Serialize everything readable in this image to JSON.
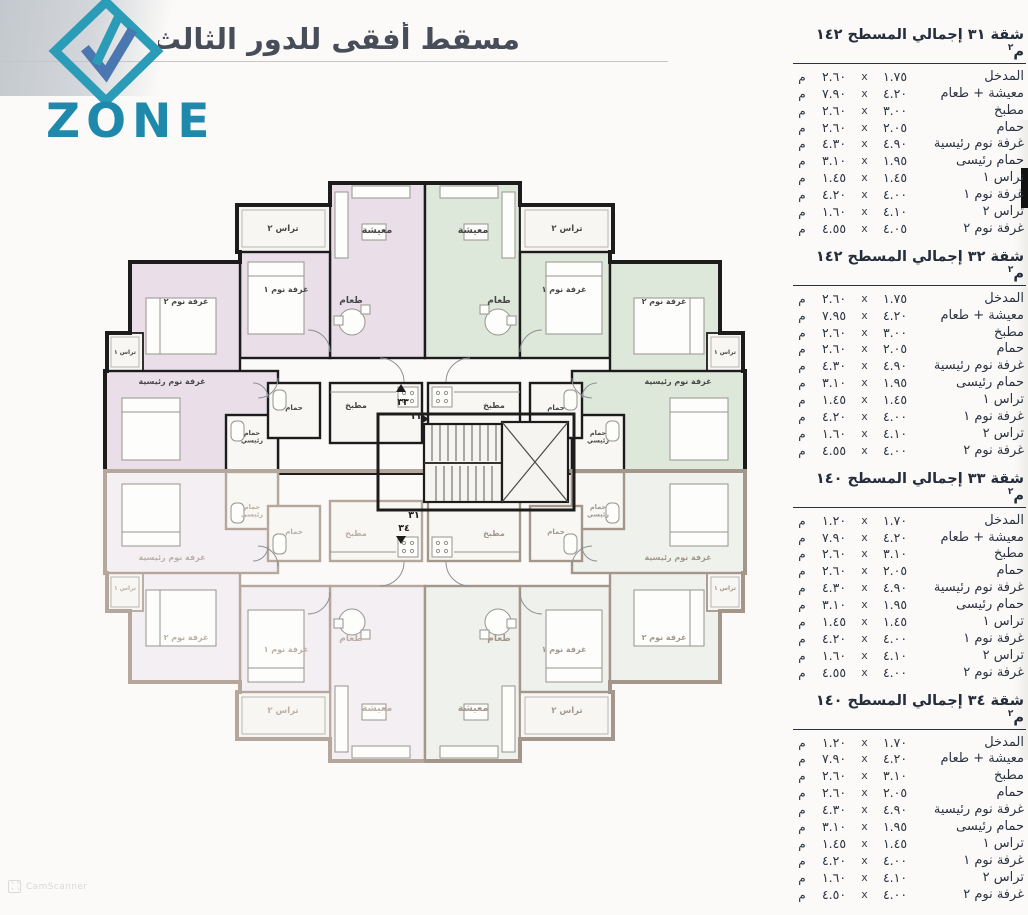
{
  "header": {
    "title": "مسقط أفقى للدور الثالث"
  },
  "logo": {
    "brand": "ZONE",
    "diamond_color": "#2a9cb7",
    "arrow_color": "#4a77b0",
    "text_color": "#1f89ac"
  },
  "tables": [
    {
      "title": "شقة ٣١ إجمالي المسطح ١٤٢ م",
      "title_sup": "٢",
      "rows": [
        {
          "label": "المدخل",
          "d1": "١.٧٥",
          "x": "x",
          "d2": "٢.٦٠",
          "unit": "م"
        },
        {
          "label": "معيشة + طعام",
          "d1": "٤.٢٠",
          "x": "x",
          "d2": "٧.٩٠",
          "unit": "م"
        },
        {
          "label": "مطبخ",
          "d1": "٣.٠٠",
          "x": "x",
          "d2": "٢.٦٠",
          "unit": "م"
        },
        {
          "label": "حمام",
          "d1": "٢.٠٥",
          "x": "x",
          "d2": "٢.٦٠",
          "unit": "م"
        },
        {
          "label": "غرفة نوم رئيسية",
          "d1": "٤.٩٠",
          "x": "x",
          "d2": "٤.٣٠",
          "unit": "م"
        },
        {
          "label": "حمام رئيسى",
          "d1": "١.٩٥",
          "x": "x",
          "d2": "٣.١٠",
          "unit": "م"
        },
        {
          "label": "تراس ١",
          "d1": "١.٤٥",
          "x": "x",
          "d2": "١.٤٥",
          "unit": "م"
        },
        {
          "label": "غرفة نوم ١",
          "d1": "٤.٠٠",
          "x": "x",
          "d2": "٤.٢٠",
          "unit": "م"
        },
        {
          "label": "تراس ٢",
          "d1": "٤.١٠",
          "x": "x",
          "d2": "١.٦٠",
          "unit": "م"
        },
        {
          "label": "غرفة نوم ٢",
          "d1": "٤.٠٥",
          "x": "x",
          "d2": "٤.٥٥",
          "unit": "م"
        }
      ]
    },
    {
      "title": "شقة ٣٢ إجمالي المسطح ١٤٢ م",
      "title_sup": "٢",
      "rows": [
        {
          "label": "المدخل",
          "d1": "١.٧٥",
          "x": "x",
          "d2": "٢.٦٠",
          "unit": "م"
        },
        {
          "label": "معيشة + طعام",
          "d1": "٤.٢٠",
          "x": "x",
          "d2": "٧.٩٥",
          "unit": "م"
        },
        {
          "label": "مطبخ",
          "d1": "٣.٠٠",
          "x": "x",
          "d2": "٢.٦٠",
          "unit": "م"
        },
        {
          "label": "حمام",
          "d1": "٢.٠٥",
          "x": "x",
          "d2": "٢.٦٠",
          "unit": "م"
        },
        {
          "label": "غرفة نوم رئيسية",
          "d1": "٤.٩٠",
          "x": "x",
          "d2": "٤.٣٠",
          "unit": "م"
        },
        {
          "label": "حمام رئيسى",
          "d1": "١.٩٥",
          "x": "x",
          "d2": "٣.١٠",
          "unit": "م"
        },
        {
          "label": "تراس ١",
          "d1": "١.٤٥",
          "x": "x",
          "d2": "١.٤٥",
          "unit": "م"
        },
        {
          "label": "غرفة نوم ١",
          "d1": "٤.٠٠",
          "x": "x",
          "d2": "٤.٢٠",
          "unit": "م"
        },
        {
          "label": "تراس ٢",
          "d1": "٤.١٠",
          "x": "x",
          "d2": "١.٦٠",
          "unit": "م"
        },
        {
          "label": "غرفة نوم ٢",
          "d1": "٤.٠٠",
          "x": "x",
          "d2": "٤.٥٥",
          "unit": "م"
        }
      ]
    },
    {
      "title": "شقة ٣٣ إجمالي المسطح ١٤٠ م",
      "title_sup": "٢",
      "rows": [
        {
          "label": "المدخل",
          "d1": "١.٧٠",
          "x": "x",
          "d2": "١.٢٠",
          "unit": "م"
        },
        {
          "label": "معيشة + طعام",
          "d1": "٤.٢٠",
          "x": "x",
          "d2": "٧.٩٠",
          "unit": "م"
        },
        {
          "label": "مطبخ",
          "d1": "٣.١٠",
          "x": "x",
          "d2": "٢.٦٠",
          "unit": "م"
        },
        {
          "label": "حمام",
          "d1": "٢.٠٥",
          "x": "x",
          "d2": "٢.٦٠",
          "unit": "م"
        },
        {
          "label": "غرفة نوم رئيسية",
          "d1": "٤.٩٠",
          "x": "x",
          "d2": "٤.٣٠",
          "unit": "م"
        },
        {
          "label": "حمام رئيسى",
          "d1": "١.٩٥",
          "x": "x",
          "d2": "٣.١٠",
          "unit": "م"
        },
        {
          "label": "تراس ١",
          "d1": "١.٤٥",
          "x": "x",
          "d2": "١.٤٥",
          "unit": "م"
        },
        {
          "label": "غرفة نوم ١",
          "d1": "٤.٠٠",
          "x": "x",
          "d2": "٤.٢٠",
          "unit": "م"
        },
        {
          "label": "تراس ٢",
          "d1": "٤.١٠",
          "x": "x",
          "d2": "١.٦٠",
          "unit": "م"
        },
        {
          "label": "غرفة نوم ٢",
          "d1": "٤.٠٠",
          "x": "x",
          "d2": "٤.٥٥",
          "unit": "م"
        }
      ]
    },
    {
      "title": "شقة ٣٤ إجمالي المسطح ١٤٠ م",
      "title_sup": "٢",
      "rows": [
        {
          "label": "المدخل",
          "d1": "١.٧٠",
          "x": "x",
          "d2": "١.٢٠",
          "unit": "م"
        },
        {
          "label": "معيشة + طعام",
          "d1": "٤.٢٠",
          "x": "x",
          "d2": "٧.٩٠",
          "unit": "م"
        },
        {
          "label": "مطبخ",
          "d1": "٣.١٠",
          "x": "x",
          "d2": "٢.٦٠",
          "unit": "م"
        },
        {
          "label": "حمام",
          "d1": "٢.٠٥",
          "x": "x",
          "d2": "٢.٦٠",
          "unit": "م"
        },
        {
          "label": "غرفة نوم رئيسية",
          "d1": "٤.٩٠",
          "x": "x",
          "d2": "٤.٣٠",
          "unit": "م"
        },
        {
          "label": "حمام رئيسى",
          "d1": "١.٩٥",
          "x": "x",
          "d2": "٣.١٠",
          "unit": "م"
        },
        {
          "label": "تراس ١",
          "d1": "١.٤٥",
          "x": "x",
          "d2": "١.٤٥",
          "unit": "م"
        },
        {
          "label": "غرفة نوم ١",
          "d1": "٤.٠٠",
          "x": "x",
          "d2": "٤.٢٠",
          "unit": "م"
        },
        {
          "label": "تراس ٢",
          "d1": "٤.١٠",
          "x": "x",
          "d2": "١.٦٠",
          "unit": "م"
        },
        {
          "label": "غرفة نوم ٢",
          "d1": "٤.٠٠",
          "x": "x",
          "d2": "٤.٥٠",
          "unit": "م"
        }
      ]
    }
  ],
  "floor_plan": {
    "quadrants": [
      {
        "name": "apartment-top-left",
        "tint": "#eadfe9",
        "wall": "#1c1c1c",
        "label_color": "#474747",
        "faint": false
      },
      {
        "name": "apartment-top-right",
        "tint": "#dde8da",
        "wall": "#1c1c1c",
        "label_color": "#474747",
        "faint": false
      },
      {
        "name": "apartment-bottom-left",
        "tint": "#f4eff3",
        "wall": "#b6a79c",
        "label_color": "#bcafa6",
        "faint": true
      },
      {
        "name": "apartment-bottom-right",
        "tint": "#eef1ec",
        "wall": "#a5968c",
        "label_color": "#a3968e",
        "faint": true
      }
    ],
    "room_labels": [
      {
        "key": "living",
        "text": "معيشة",
        "x": 377,
        "y": 233,
        "size": 9.5
      },
      {
        "key": "dining",
        "text": "طعام",
        "x": 351,
        "y": 303,
        "size": 9
      },
      {
        "key": "terrace-2",
        "text": "تراس ٢",
        "x": 283,
        "y": 231,
        "size": 8.5
      },
      {
        "key": "bedroom-1",
        "text": "غرفة نوم ١",
        "x": 286,
        "y": 292,
        "size": 8
      },
      {
        "key": "bedroom-2",
        "text": "غرفة نوم ٢",
        "x": 186,
        "y": 304,
        "size": 8
      },
      {
        "key": "terrace-1",
        "text": "تراس ١",
        "x": 125,
        "y": 354,
        "size": 6
      },
      {
        "key": "master-bed",
        "text": "غرفة نوم رئيسية",
        "x": 172,
        "y": 384,
        "size": 8
      },
      {
        "key": "master-bath",
        "lines": [
          "حمام",
          "رئيسي"
        ],
        "x": 252,
        "y": 435,
        "size": 6.5
      },
      {
        "key": "bath",
        "text": "حمام",
        "x": 294,
        "y": 410,
        "size": 7
      },
      {
        "key": "kitchen",
        "text": "مطبخ",
        "x": 356,
        "y": 408,
        "size": 8
      }
    ],
    "apartment_numbers": [
      {
        "text": "٣٣",
        "x": 403,
        "y": 405
      },
      {
        "text": "٣٢",
        "x": 417,
        "y": 419
      },
      {
        "text": "٣١",
        "x": 414,
        "y": 518
      },
      {
        "text": "٣٤",
        "x": 404,
        "y": 531
      }
    ]
  },
  "watermark": {
    "text": "CamScanner"
  }
}
